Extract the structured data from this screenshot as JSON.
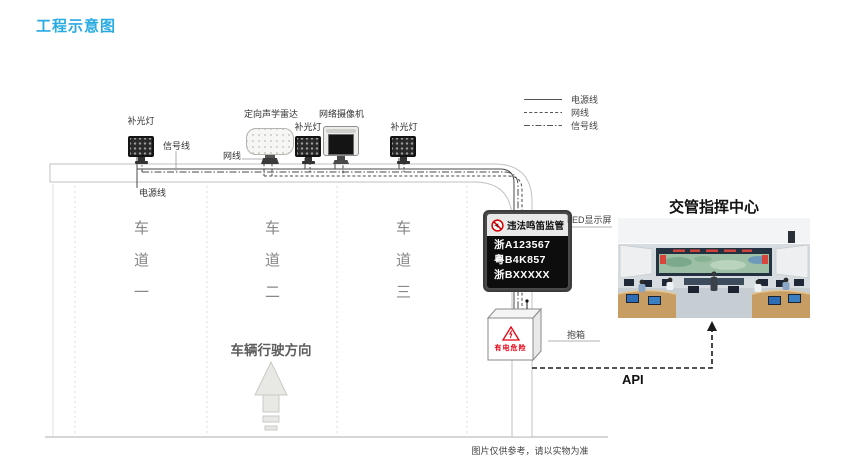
{
  "title": "工程示意图",
  "legend": {
    "power": "电源线",
    "network": "网线",
    "signal": "信号线"
  },
  "gantry": {
    "fill_light": "补光灯",
    "radar": "定向声学雷达",
    "camera": "网络摄像机",
    "signal_label": "信号线",
    "network_label": "网线",
    "power_label": "电源线"
  },
  "lanes": {
    "lane1": "车道一",
    "lane2": "车道二",
    "lane3": "车道三",
    "direction": "车辆行驶方向"
  },
  "led_display": {
    "callout": "LED显示屏",
    "header": "违法鸣笛监管",
    "plates": [
      "浙A123567",
      "粤B4K857",
      "浙BXXXXX"
    ]
  },
  "cabinet": {
    "callout": "抱箱",
    "warning": "有电危险"
  },
  "command_center": {
    "title": "交管指挥中心",
    "api_label": "API"
  },
  "footer": "图片仅供参考，请以实物为准",
  "colors": {
    "accent": "#29abe2",
    "warning_red": "#e60012",
    "cable_gray": "#4a4a4a"
  }
}
